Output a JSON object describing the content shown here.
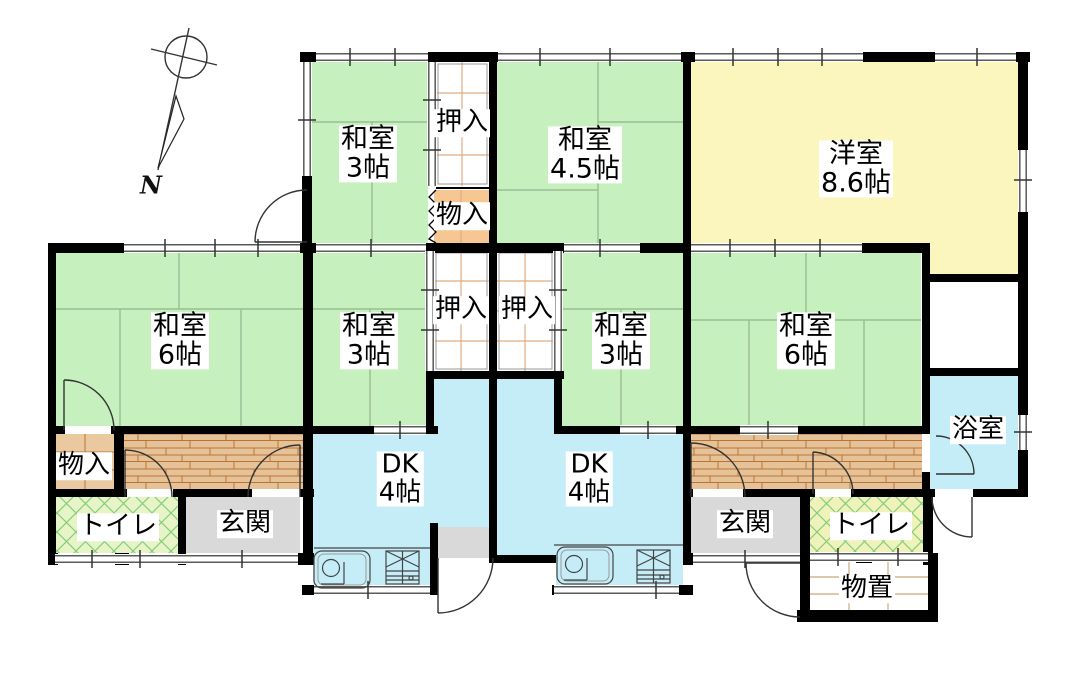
{
  "plan": {
    "compass_label": "N"
  },
  "rooms": {
    "wa3_top": {
      "name": "和室",
      "size": "3帖"
    },
    "oshiire_top": {
      "name": "押入"
    },
    "mono_top": {
      "name": "物入"
    },
    "wa45": {
      "name": "和室",
      "size": "4.5帖"
    },
    "yoshitsu": {
      "name": "洋室",
      "size": "8.6帖"
    },
    "wa6_left": {
      "name": "和室",
      "size": "6帖"
    },
    "wa3_mid": {
      "name": "和室",
      "size": "3帖"
    },
    "oshiire_left": {
      "name": "押入"
    },
    "oshiire_right": {
      "name": "押入"
    },
    "wa3_right": {
      "name": "和室",
      "size": "3帖"
    },
    "wa6_right": {
      "name": "和室",
      "size": "6帖"
    },
    "bath": {
      "name": "浴室"
    },
    "mono_left": {
      "name": "物入"
    },
    "toilet_left": {
      "name": "トイレ"
    },
    "genkan_left": {
      "name": "玄関"
    },
    "dk_left": {
      "name": "DK",
      "size": "4帖"
    },
    "dk_right": {
      "name": "DK",
      "size": "4帖"
    },
    "genkan_right": {
      "name": "玄関"
    },
    "toilet_right": {
      "name": "トイレ"
    },
    "storage": {
      "name": "物置"
    }
  },
  "colors": {
    "wall": "#000000",
    "tatami": "#c6f0bd",
    "tatami_line": "#9cbd95",
    "western_room": "#fbf5be",
    "water_blue": "#c5edf8",
    "wood_floor": "#e6c298",
    "wood_line": "#b97433",
    "entry_gray": "#d9d9d9",
    "storage_tan": "#eac9a0",
    "toilet_left_bg": "#e7f4c8",
    "toilet_right_bg": "#f0f2bc",
    "hatch_green": "#86ce77",
    "closet_grid": "#e2ac7e",
    "storage_grid": "#cfa878",
    "window_line": "#5a5a5a"
  }
}
